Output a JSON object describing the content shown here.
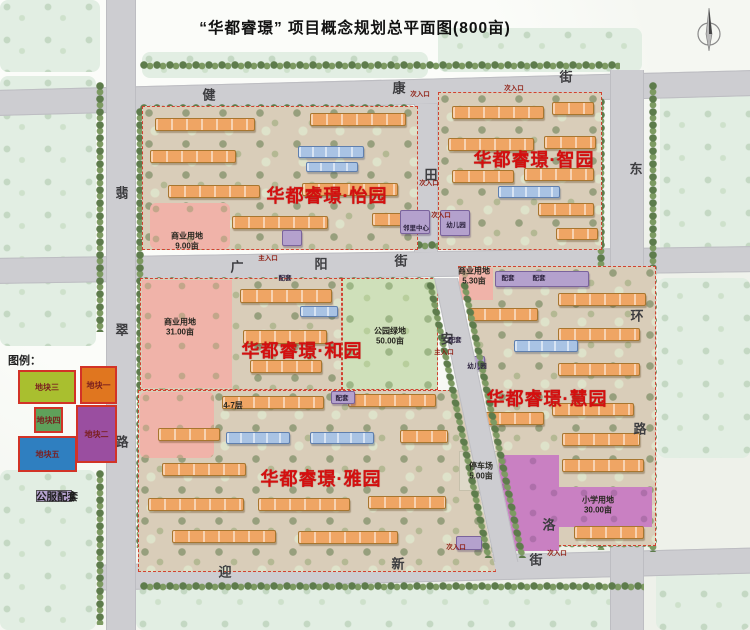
{
  "title": "“华都睿璟” 项目概念规划总平面图(800亩)",
  "colors": {
    "accent_red": "#d40f0f",
    "road_gray": "#cdcdd1",
    "parcel_tan": "#d9cdb9",
    "commercial_pink": "#f0b3a9",
    "park_green": "#cfe0ba",
    "school_magenta": "#c980c2",
    "tower_orange": "#efa564",
    "villa_blue": "#a9c3e4",
    "public_purple": "#b4a1cd"
  },
  "communities": [
    {
      "name": "华都睿璟·怡园",
      "x": 327,
      "y": 195
    },
    {
      "name": "华都睿璟·智园",
      "x": 534,
      "y": 159
    },
    {
      "name": "华都睿璟·和园",
      "x": 302,
      "y": 350
    },
    {
      "name": "华都睿璟·慧园",
      "x": 547,
      "y": 398
    },
    {
      "name": "华都睿璟·雅园",
      "x": 321,
      "y": 478
    }
  ],
  "street_chars": [
    {
      "t": "健",
      "x": 209,
      "y": 94
    },
    {
      "t": "康",
      "x": 399,
      "y": 87
    },
    {
      "t": "街",
      "x": 566,
      "y": 76
    },
    {
      "t": "广",
      "x": 237,
      "y": 266
    },
    {
      "t": "阳",
      "x": 321,
      "y": 263
    },
    {
      "t": "街",
      "x": 401,
      "y": 260
    },
    {
      "t": "迎",
      "x": 225,
      "y": 571
    },
    {
      "t": "新",
      "x": 398,
      "y": 563
    },
    {
      "t": "街",
      "x": 536,
      "y": 559
    },
    {
      "t": "翡",
      "x": 122,
      "y": 192
    },
    {
      "t": "翠",
      "x": 122,
      "y": 329
    },
    {
      "t": "路",
      "x": 122,
      "y": 441
    },
    {
      "t": "东",
      "x": 636,
      "y": 168
    },
    {
      "t": "环",
      "x": 637,
      "y": 315
    },
    {
      "t": "路",
      "x": 640,
      "y": 428
    },
    {
      "t": "田",
      "x": 431,
      "y": 174
    },
    {
      "t": "安",
      "x": 447,
      "y": 338
    },
    {
      "t": "洛",
      "x": 549,
      "y": 524
    }
  ],
  "land_labels": [
    {
      "line1": "商业用地",
      "line2": "9.00亩",
      "x": 187,
      "y": 241
    },
    {
      "line1": "商业用地",
      "line2": "31.00亩",
      "x": 180,
      "y": 327
    },
    {
      "line1": "公园绿地",
      "line2": "50.00亩",
      "x": 390,
      "y": 336
    },
    {
      "line1": "商业用地",
      "line2": "5.30亩",
      "x": 474,
      "y": 276
    },
    {
      "line1": "停车场",
      "line2": "5.00亩",
      "x": 481,
      "y": 471
    },
    {
      "line1": "小学用地",
      "line2": "30.00亩",
      "x": 598,
      "y": 505
    },
    {
      "line1": "4-7层",
      "line2": "",
      "x": 233,
      "y": 406
    }
  ],
  "poi_labels": [
    {
      "t": "邻里中心",
      "x": 416,
      "y": 227
    },
    {
      "t": "幼儿园",
      "x": 456,
      "y": 224
    },
    {
      "t": "幼儿园",
      "x": 477,
      "y": 365
    },
    {
      "t": "配套",
      "x": 285,
      "y": 277
    },
    {
      "t": "配套",
      "x": 508,
      "y": 277
    },
    {
      "t": "配套",
      "x": 539,
      "y": 277
    },
    {
      "t": "配套",
      "x": 455,
      "y": 339
    },
    {
      "t": "配套",
      "x": 342,
      "y": 397
    }
  ],
  "entrances": [
    {
      "t": "次入口",
      "x": 420,
      "y": 93
    },
    {
      "t": "次入口",
      "x": 514,
      "y": 87
    },
    {
      "t": "次入口",
      "x": 429,
      "y": 182
    },
    {
      "t": "主入口",
      "x": 268,
      "y": 257
    },
    {
      "t": "次入口",
      "x": 441,
      "y": 214
    },
    {
      "t": "主入口",
      "x": 444,
      "y": 351
    },
    {
      "t": "次入口",
      "x": 456,
      "y": 546
    },
    {
      "t": "次入口",
      "x": 557,
      "y": 552
    }
  ],
  "legend_map": {
    "title": "图例：",
    "items": [
      {
        "label": "地块三",
        "color": "#a9bf2f"
      },
      {
        "label": "地块一",
        "color": "#e0761f"
      },
      {
        "label": "地块四",
        "color": "#5fa05a"
      },
      {
        "label": "地块二",
        "color": "#9a4ea0"
      },
      {
        "label": "地块五",
        "color": "#2f7fc0"
      }
    ]
  },
  "legend_buildings": [
    {
      "label": "17F高层",
      "color": "#efa564"
    },
    {
      "label": "10F洋房",
      "color": "#a9c3e4"
    },
    {
      "label": "公服配套",
      "color": "#b4a1cd"
    }
  ]
}
